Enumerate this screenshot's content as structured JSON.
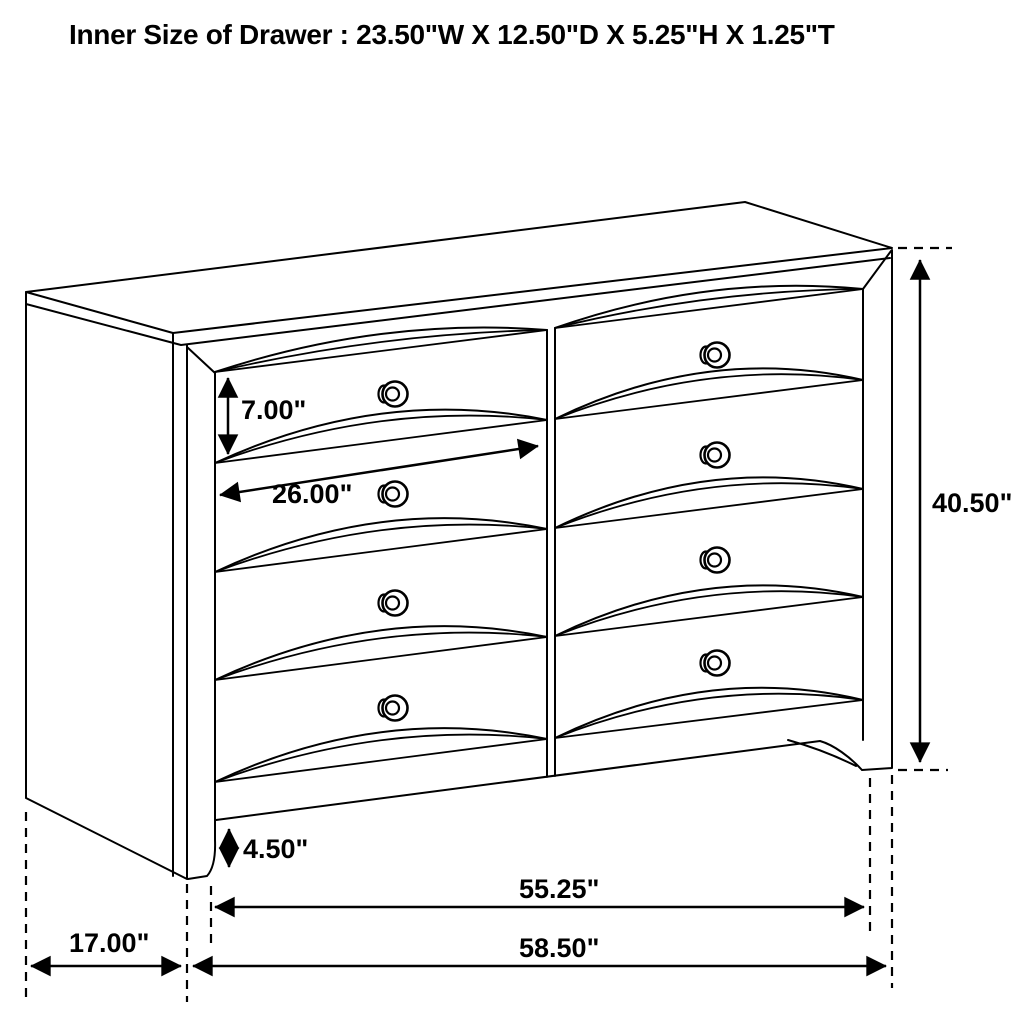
{
  "title": "Inner Size of Drawer : 23.50\"W X 12.50\"D X 5.25\"H X 1.25\"T",
  "colors": {
    "line": "#000000",
    "background": "#ffffff"
  },
  "dimensions": {
    "drawer_front_height": "7.00\"",
    "drawer_width": "26.00\"",
    "overall_height": "40.50\"",
    "base_height": "4.50\"",
    "front_width": "55.25\"",
    "overall_width": "58.50\"",
    "side_depth": "17.00\""
  }
}
